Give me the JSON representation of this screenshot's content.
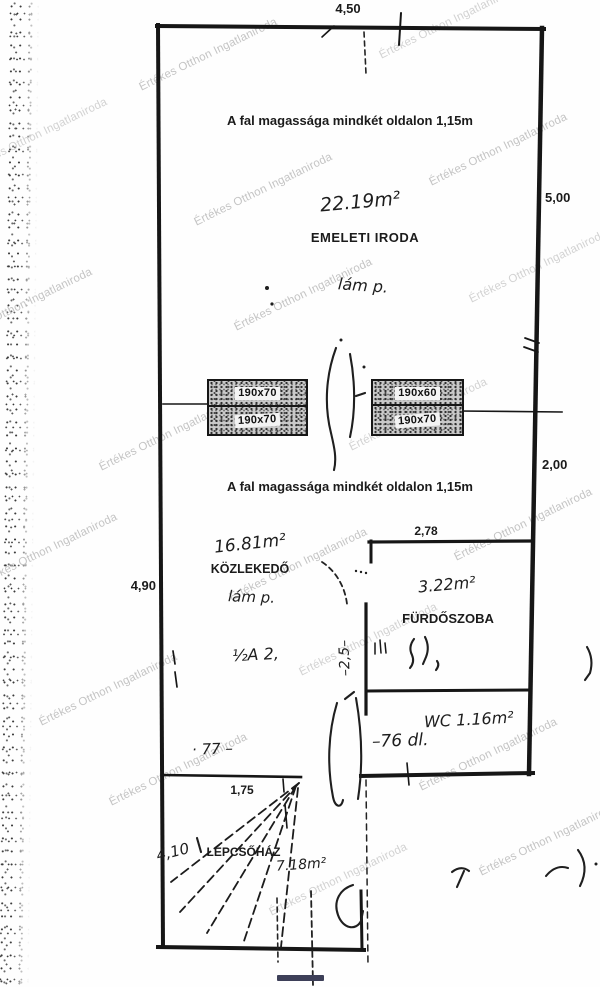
{
  "watermark": {
    "text": "Értékes Otthon Ingatlaniroda"
  },
  "notes": {
    "wall_height": "A fal magassága mindkét oldalon 1,15m"
  },
  "rooms": [
    {
      "name": "EMELETI IRODA",
      "area": "22.19m²"
    },
    {
      "name": "KÖZLEKEDŐ",
      "area": "16.81m²"
    },
    {
      "name": "FÜRDŐSZOBA",
      "area": "3.22m²"
    },
    {
      "name": "WC",
      "area": "1.16m²"
    },
    {
      "name": "LÉPCSŐHÁZ",
      "area": "7.18m²"
    }
  ],
  "dimensions": {
    "top": "4,50",
    "right_upper": "5,00",
    "right_lower": "2,00",
    "left": "4,90",
    "bathroom": "2,78",
    "stair": "1,75"
  },
  "windows": [
    {
      "labels": [
        "190x70",
        "190x70"
      ]
    },
    {
      "labels": [
        "190x60",
        "190x70"
      ]
    }
  ],
  "handwriting": {
    "lamp1": "lám p.",
    "lamp2": "lám p.",
    "corridor_extra": "½A 2,",
    "vertical": "–2,5–",
    "wc_extra": "–76 dl.",
    "stair_top": "· 77 –",
    "stair_side": "4,10"
  },
  "colors": {
    "ink": "#161616",
    "watermark": "#c4c4c4",
    "bar": "#3d3f58"
  }
}
